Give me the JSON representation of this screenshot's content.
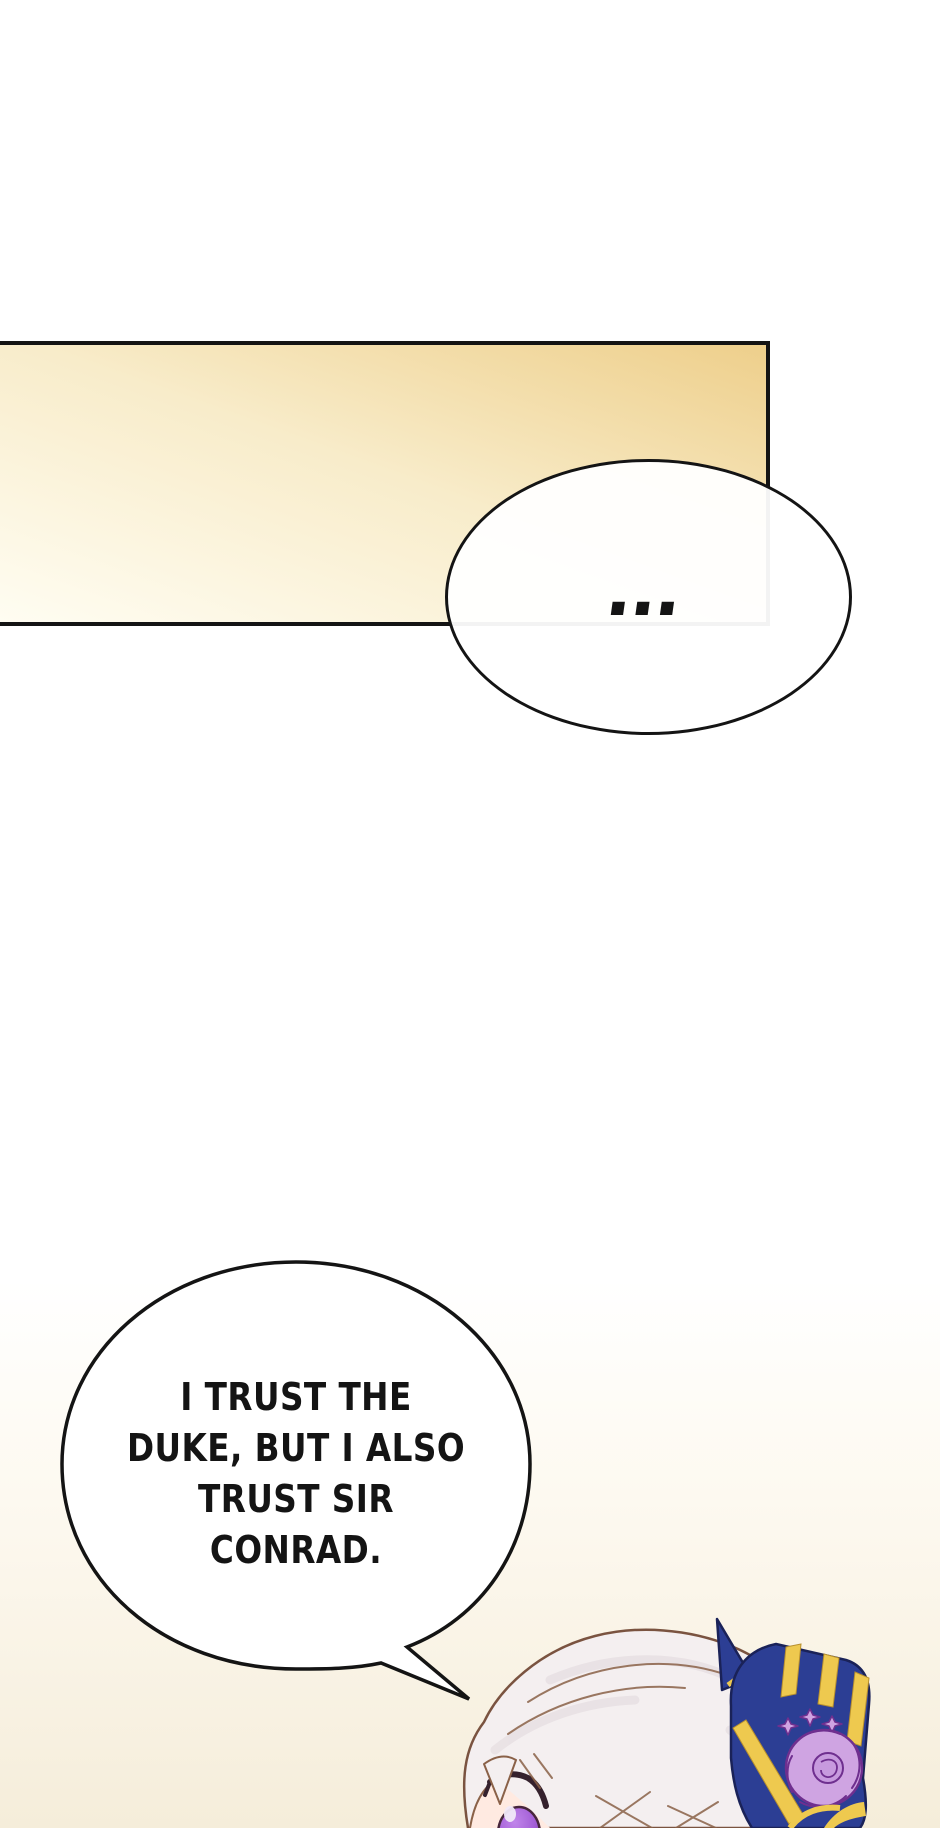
{
  "page": {
    "width": 940,
    "height": 1828,
    "background": "#ffffff",
    "bottom_tint": "#f5edda"
  },
  "flashback_panel": {
    "border_color": "#141414",
    "gradient_start": "#fffdf2",
    "gradient_mid": "#f8ecca",
    "gradient_end": "#eecf8b"
  },
  "bubbles": {
    "ellipsis": {
      "text": "...",
      "fill": "#ffffff",
      "outline_color": "#141414"
    },
    "trust": {
      "lines": [
        "I TRUST THE",
        "DUKE, BUT I ALSO",
        "TRUST SIR",
        "CONRAD."
      ],
      "text_color": "#141414",
      "fill": "#ffffff",
      "outline_color": "#141414"
    }
  },
  "character": {
    "colors": {
      "hair": "#f4eff0",
      "hair_outline": "#7a5340",
      "hair_strand": "#8a6148",
      "hair_shade": "#e3dade",
      "skin": "#ffeae1",
      "eye_iris_light": "#c084ea",
      "eye_iris_dark": "#8a42bf",
      "eye_outline": "#47263c",
      "eyelash": "#35212d",
      "bow": "#2c3e94",
      "bow_outline": "#1a2258",
      "bow_gold": "#eec94f",
      "bow_gold_edge": "#b8902e",
      "rose": "#cfa4e2",
      "rose_inner": "#c79ade",
      "rose_outline": "#6f2f8f"
    }
  }
}
